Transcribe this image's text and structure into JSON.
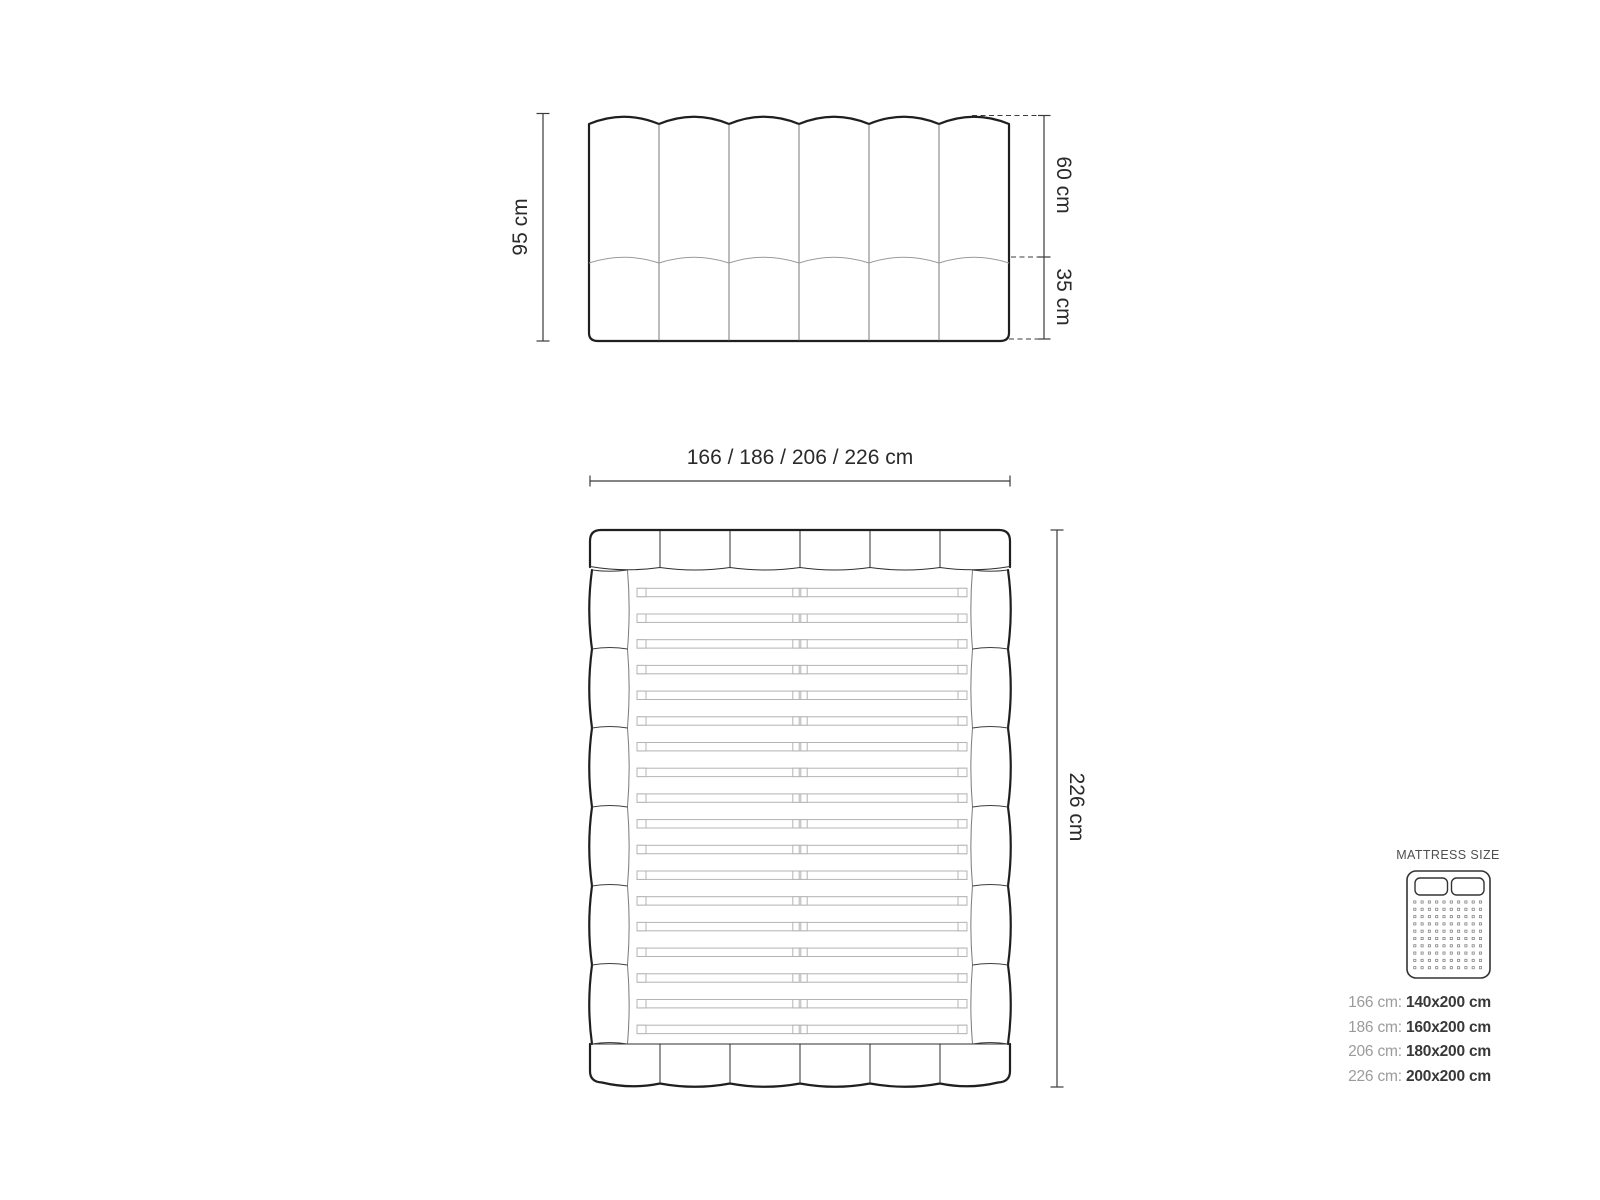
{
  "front_view": {
    "height_label": "95 cm",
    "upper_section_label": "60 cm",
    "lower_section_label": "35 cm"
  },
  "top_view": {
    "width_label": "166 / 186 / 206 / 226 cm",
    "length_label": "226 cm"
  },
  "legend": {
    "title": "MATTRESS SIZE",
    "rows": [
      {
        "frame": "166 cm:",
        "mattress": "140x200 cm"
      },
      {
        "frame": "186 cm:",
        "mattress": "160x200 cm"
      },
      {
        "frame": "206 cm:",
        "mattress": "180x200 cm"
      },
      {
        "frame": "226 cm:",
        "mattress": "200x200 cm"
      }
    ]
  },
  "colors": {
    "outline": "#1f1f1f",
    "dimension": "#3b3b3b",
    "slat": "#b4b4b4",
    "label_gray": "#9b9b9b",
    "value_dark": "#383838",
    "text": "#2a2a2a",
    "legend_title": "#4f4f4f"
  },
  "drawing": {
    "front_channels": 6,
    "rail_segments": 6,
    "side_segments": 6,
    "slats": 18,
    "dots_cols": 10,
    "dots_rows": 10
  }
}
